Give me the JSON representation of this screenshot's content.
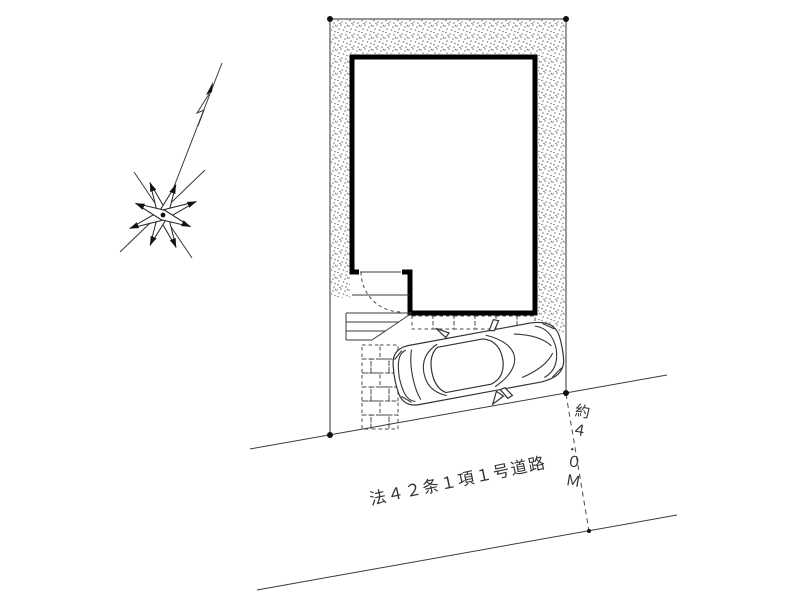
{
  "labels": {
    "road_name": "法４２条１項１号道路",
    "road_width": "約４．０Ｍ",
    "road_width_chars": [
      "約",
      "４",
      "．",
      "０",
      "Ｍ"
    ]
  },
  "colors": {
    "paper": "#ffffff",
    "wall": "#000000",
    "line": "#3a3a3a",
    "boundary": "#555555",
    "stipple_dot": "#7a7a7a",
    "text": "#333333"
  },
  "icons": {
    "north_arrow": "compass-star-icon"
  }
}
